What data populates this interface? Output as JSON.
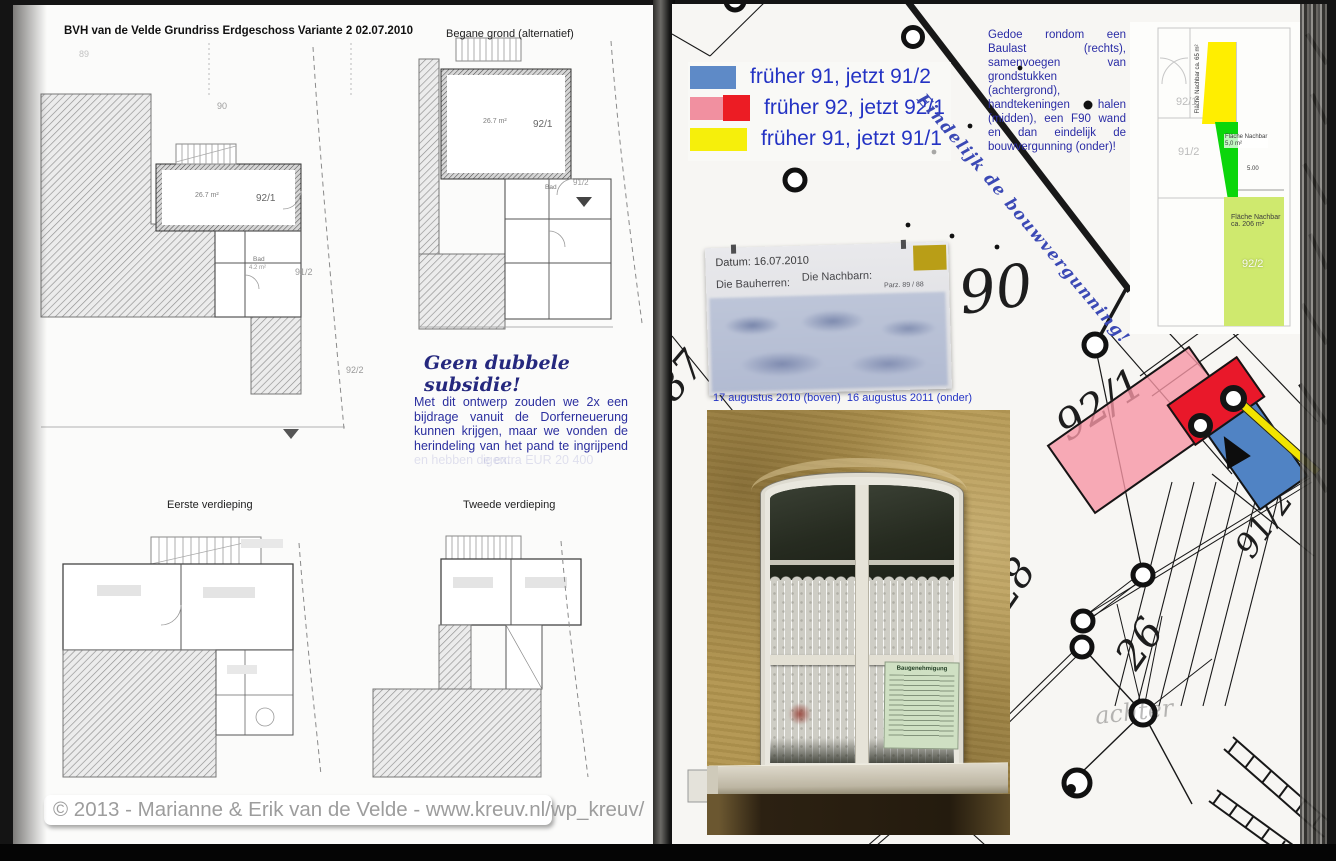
{
  "left_page": {
    "title": "BVH van de Velde Grundriss Erdgeschoss Variante 2 02.07.2010",
    "plans": {
      "main": {
        "parcel_top": "90",
        "parcel_far": "89",
        "area": "26.7 m²",
        "unit": "92/1",
        "bad": "Bad",
        "bad_area": "4.2 m²",
        "parcel_right": "91/2",
        "parcel_bottom": "92/2"
      },
      "alt": {
        "caption": "Begane grond (alternatief)",
        "area": "26.7 m²",
        "unit": "92/1",
        "bad": "Bad",
        "parcel_right": "91/2"
      },
      "first": {
        "caption": "Eerste verdieping"
      },
      "second": {
        "caption": "Tweede verdieping"
      }
    },
    "subsidy": {
      "heading": "Geen dubbele subsidie!",
      "body": "Met dit ontwerp zouden we 2x een bijdrage vanuit de Dorferneuerung kunnen krijgen, maar we vonden de herindeling van het pand te ingrijpend ",
      "faded": "en hebben de extra EUR 20 400",
      "faded2": "igen."
    },
    "copyright": "© 2013 - Marianne & Erik van de Velde - www.kreuv.nl/wp_kreuv/"
  },
  "right_page": {
    "legend": {
      "items": [
        {
          "label": "früher 91, jetzt 91/2",
          "swatch": "#5e8ac7"
        },
        {
          "label": "früher 92, jetzt 92/1",
          "swatch": "#f190a0",
          "swatch2": "#ec1c24"
        },
        {
          "label": "früher 91, jetzt 91/1",
          "swatch": "#f6ef0b"
        }
      ]
    },
    "note": "Gedoe rondom een Baulast (rechts), samenvoegen van grondstukken (achtergrond), handtekeningen halen (midden), een F90 wand en dan eindelijk de bouwvergunning (onder)!",
    "diagonal_caption": "Eindelijk de bouwvergunning!",
    "permit_doc": {
      "datum": "Datum: 16.07.2010",
      "bauherren": "Die Bauherren:",
      "nachbarn": "Die Nachbarn:",
      "parz": "Parz. 89 / 88"
    },
    "photo_caption": "17 augustus 2010 (boven)  16 augustus 2011 (onder)",
    "window_notice": "Baugenehmigung",
    "map": {
      "n90": "90",
      "n87": "87",
      "n921": "92/1",
      "n28": "28",
      "n26": "26",
      "n912": "91/2",
      "faint": "achter"
    },
    "site_plan": {
      "u921": "92/1",
      "u912": "91/2",
      "u922": "92/2",
      "yellow_label": "Fläche Nachbar",
      "yellow_area": "ca. 65 m²",
      "green_label": "Fläche Nachbar",
      "green_area": "5,0 m²",
      "lime_label": "Fläche Nachbar",
      "lime_area": "ca. 206 m²",
      "dim": "5.00"
    }
  }
}
